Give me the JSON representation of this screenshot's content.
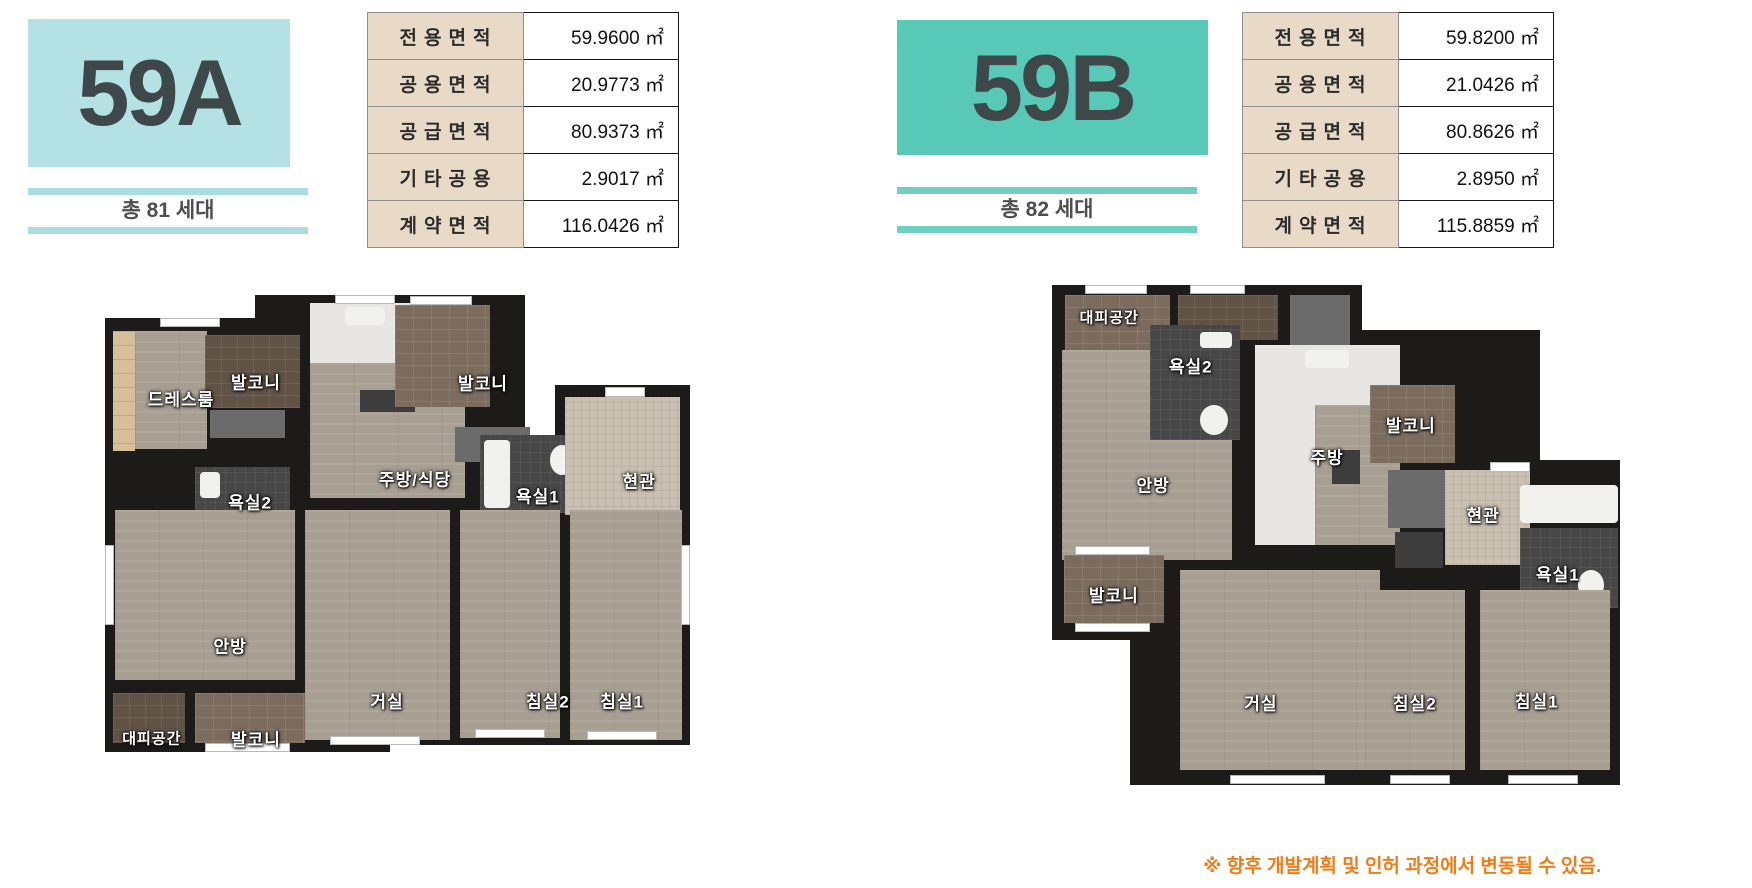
{
  "units": [
    {
      "code": "59A",
      "households": "총 81 세대",
      "area_table": [
        {
          "label": "전용면적",
          "value": "59.9600 ㎡"
        },
        {
          "label": "공용면적",
          "value": "20.9773 ㎡"
        },
        {
          "label": "공급면적",
          "value": "80.9373 ㎡"
        },
        {
          "label": "기타공용",
          "value": "2.9017 ㎡"
        },
        {
          "label": "계약면적",
          "value": "116.0426 ㎡"
        }
      ],
      "rooms": [
        "드레스룸",
        "발코니",
        "욕실2",
        "주방/식당",
        "발코니",
        "욕실1",
        "현관",
        "안방",
        "거실",
        "침실2",
        "침실1",
        "대피공간",
        "발코니"
      ]
    },
    {
      "code": "59B",
      "households": "총 82 세대",
      "area_table": [
        {
          "label": "전용면적",
          "value": "59.8200 ㎡"
        },
        {
          "label": "공용면적",
          "value": "21.0426 ㎡"
        },
        {
          "label": "공급면적",
          "value": "80.8626 ㎡"
        },
        {
          "label": "기타공용",
          "value": "2.8950 ㎡"
        },
        {
          "label": "계약면적",
          "value": "115.8859 ㎡"
        }
      ],
      "rooms": [
        "대피공간",
        "욕실2",
        "안방",
        "주방",
        "발코니",
        "현관",
        "욕실1",
        "발코니",
        "거실",
        "침실2",
        "침실1"
      ]
    }
  ],
  "footnote": "※ 향후 개발계획 및 인허 과정에서 변동될 수 있음.",
  "colors": {
    "badge_a_bg": "#b4e1e3",
    "badge_b_bg": "#58c9b6",
    "table_label_bg": "#e8dac7",
    "wall": "#1d1b19",
    "footnote_text": "#ee7d17"
  }
}
